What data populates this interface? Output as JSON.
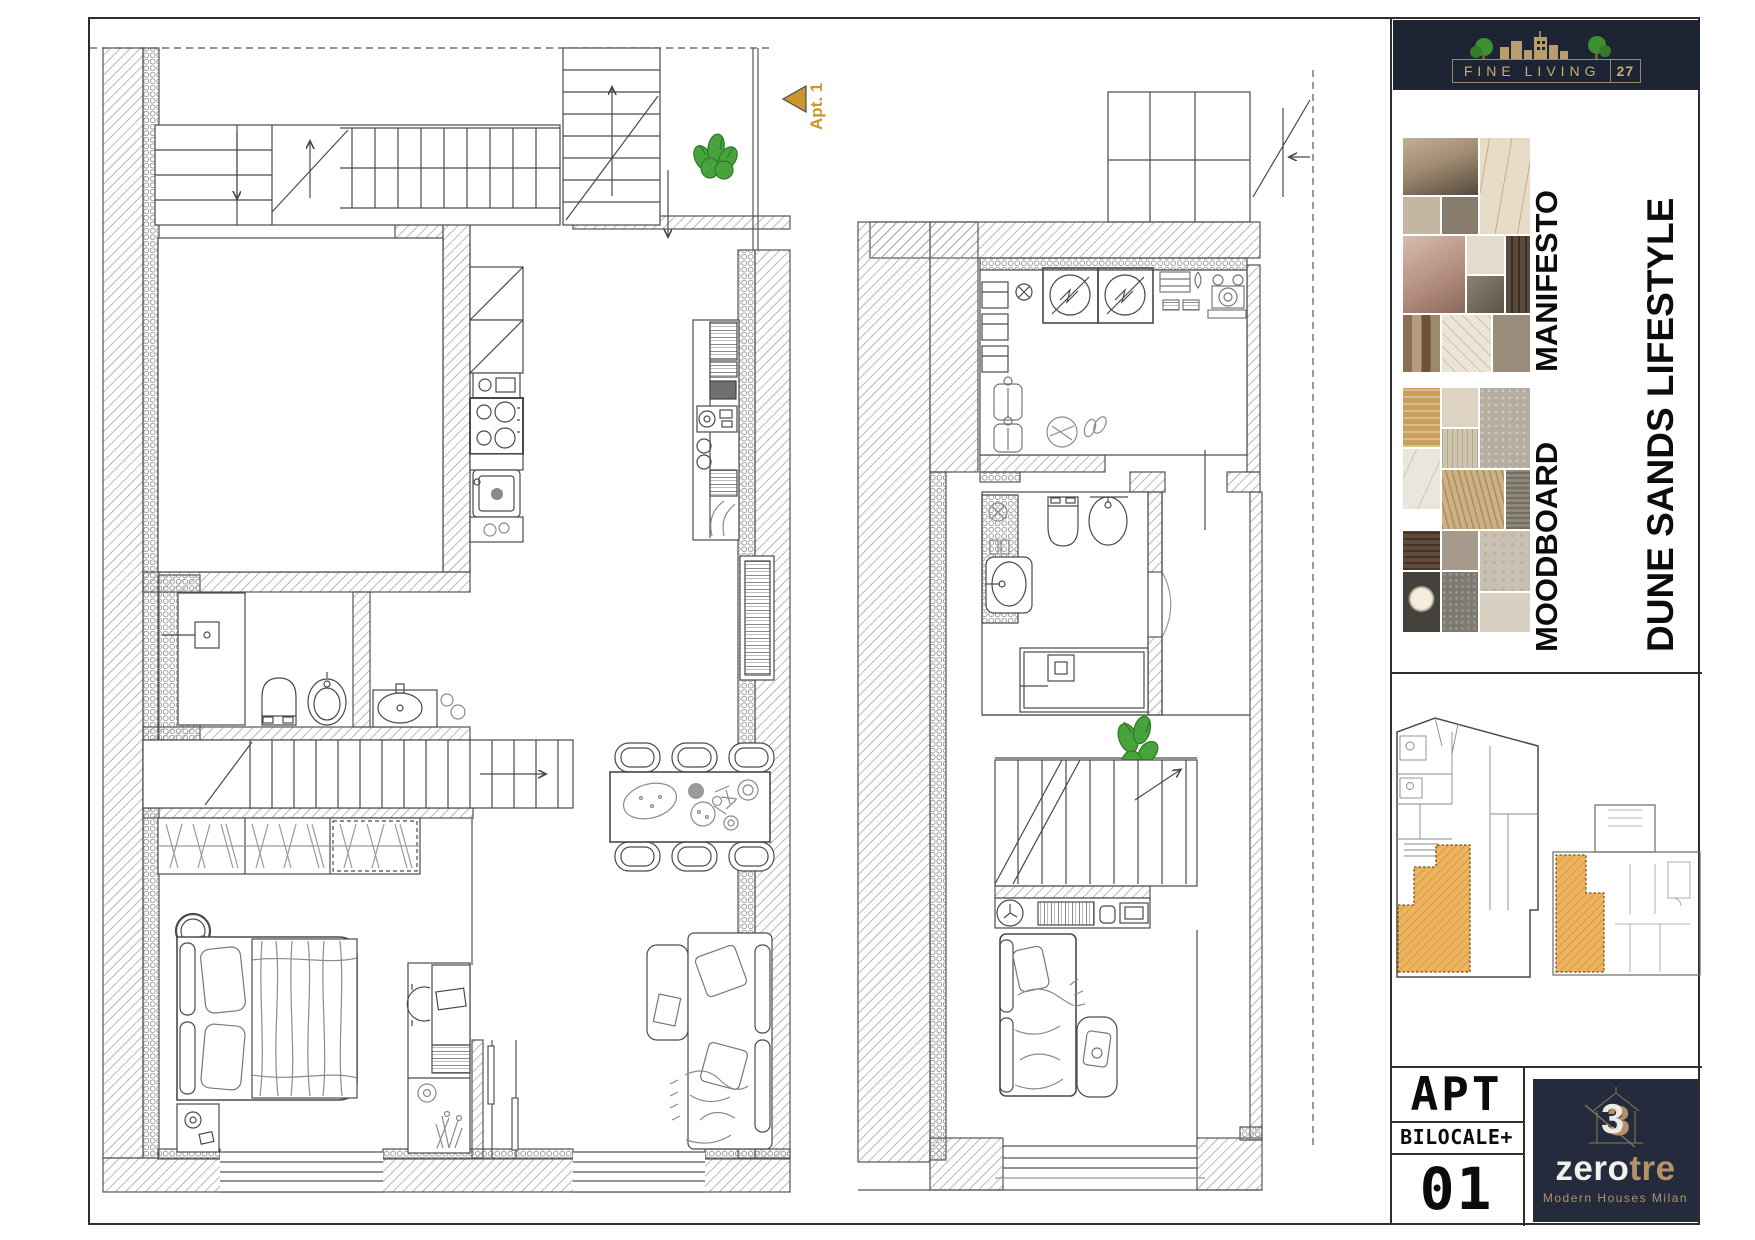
{
  "header": {
    "brand": "FINE LIVING",
    "brand_number": "27",
    "brand_bg": "#1d2433",
    "brand_gold": "#c8ac74"
  },
  "plans": {
    "apt_marker": "Apt. 1",
    "marker_color": "#c9972b"
  },
  "sidebar": {
    "manifesto_label": "MANIFESTO",
    "moodboard_label": "MOODBOARD",
    "lifestyle_label": "DUNE SANDS LIFESTYLE",
    "keyplan_highlight_color": "#edb360"
  },
  "titleblock": {
    "apt": "APT",
    "type": "BILOCALE+",
    "number": "01",
    "brand_zero": "zero",
    "brand_tre": "tre",
    "tagline": "Modern Houses Milan",
    "navy": "#232b3d",
    "gold": "#b49265"
  }
}
